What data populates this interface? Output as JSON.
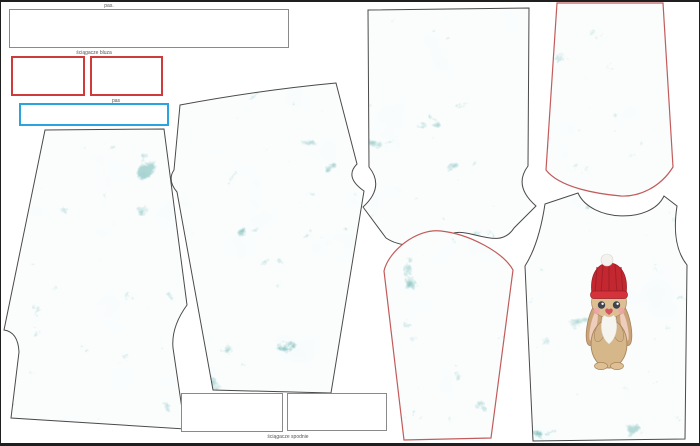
{
  "labels": {
    "waistband_top": "pas.",
    "cuffs_sweatshirt": "ściągacze bluza",
    "waistband_blue": "pas",
    "cuffs_trousers": "ściągacze spodnie"
  },
  "colors": {
    "fabric_teal": "#5badaa",
    "frost_white": "#ffffff",
    "piece_outline_gray": "#4a4a4a",
    "sleeve_outline_red": "#c25b5b",
    "rib_box_border_red": "#cf3a3a",
    "waistband_box_border_blue": "#2ba3dc",
    "box_border_gray": "#8a8a8a",
    "page_border": "#1f1f1f",
    "bunny_hat_red": "#c32730",
    "bunny_fur_tan": "#d6b78a"
  },
  "pieces": [
    {
      "name": "shorts-panel",
      "outline": "gray"
    },
    {
      "name": "pant-leg-panel",
      "outline": "gray"
    },
    {
      "name": "pant-leg-long-panel",
      "outline": "gray"
    },
    {
      "name": "sleeve-panel-center",
      "outline": "red"
    },
    {
      "name": "sleeve-panel-right",
      "outline": "red"
    },
    {
      "name": "bodice-front-panel",
      "outline": "gray",
      "graphic": "bunny-in-red-knit-hat"
    }
  ]
}
